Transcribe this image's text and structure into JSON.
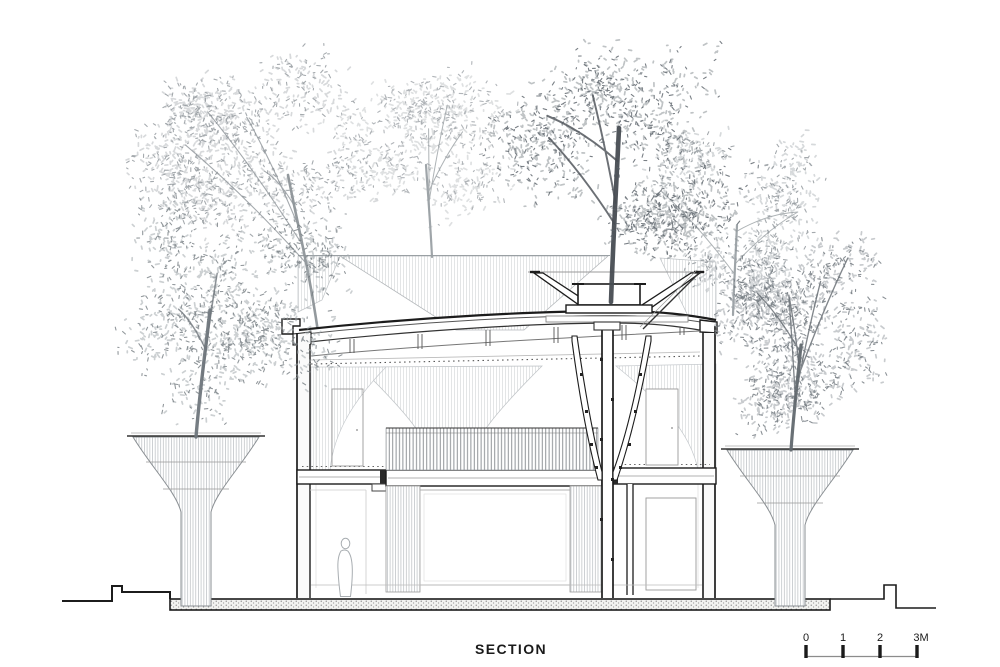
{
  "drawing": {
    "type": "architectural-section",
    "title": "SECTION",
    "scale_bar": {
      "labels": [
        "0",
        "1",
        "2",
        "3M"
      ],
      "unit": "M"
    },
    "palette": {
      "line_dark": "#1c1c1c",
      "line_medium": "#555555",
      "hatch_light": "#d7dadc",
      "hatch_body": "#c2c6c9",
      "paving_dot": "#555555",
      "background": "#ffffff"
    },
    "trees": [
      {
        "name": "tree-upper-left",
        "layer": "back",
        "cx": 265,
        "cy": 150,
        "rx": 140,
        "ry": 125,
        "shade": "#b6babe",
        "dark": "#8f959a",
        "density": 0.75,
        "seed": 11,
        "trunk": {
          "x": 318,
          "y": 332,
          "top": 175,
          "lean": -30,
          "width": 2.6,
          "color": "#8d9398"
        }
      },
      {
        "name": "tree-upper-center-left",
        "layer": "back",
        "cx": 425,
        "cy": 135,
        "rx": 105,
        "ry": 105,
        "shade": "#c2c6c9",
        "dark": "#9da3a7",
        "density": 0.6,
        "seed": 23,
        "trunk": {
          "x": 432,
          "y": 257,
          "top": 165,
          "lean": -6,
          "width": 2.2,
          "color": "#9aa0a4"
        }
      },
      {
        "name": "tree-upper-right",
        "layer": "back",
        "cx": 735,
        "cy": 200,
        "rx": 95,
        "ry": 118,
        "shade": "#b4b9bd",
        "dark": "#8d9398",
        "density": 0.6,
        "seed": 37,
        "trunk": {
          "x": 733,
          "y": 315,
          "top": 225,
          "lean": 4,
          "width": 2.2,
          "color": "#9aa0a4"
        }
      },
      {
        "name": "tree-left-planter-column",
        "layer": "front",
        "cx": 233,
        "cy": 298,
        "rx": 126,
        "ry": 140,
        "shade": "#a3a9ad",
        "dark": "#767d82",
        "density": 0.85,
        "seed": 51,
        "trunk": {
          "x": 196,
          "y": 437,
          "top": 310,
          "lean": 14,
          "width": 3.4,
          "color": "#6f767c"
        }
      },
      {
        "name": "tree-right-planter-column",
        "layer": "front",
        "cx": 800,
        "cy": 328,
        "rx": 110,
        "ry": 130,
        "shade": "#9aa1a6",
        "dark": "#6d747a",
        "density": 0.85,
        "seed": 67,
        "trunk": {
          "x": 791,
          "y": 450,
          "top": 345,
          "lean": 10,
          "width": 3.2,
          "color": "#61686e"
        }
      },
      {
        "name": "tree-central-roof-planter",
        "layer": "front",
        "cx": 625,
        "cy": 150,
        "rx": 145,
        "ry": 140,
        "shade": "#8b9196",
        "dark": "#585f66",
        "density": 1.0,
        "seed": 83,
        "trunk": {
          "x": 611,
          "y": 302,
          "top": 128,
          "lean": 8,
          "width": 4.6,
          "color": "#474c52"
        }
      }
    ],
    "figure": {
      "label": "human-silhouette"
    }
  }
}
